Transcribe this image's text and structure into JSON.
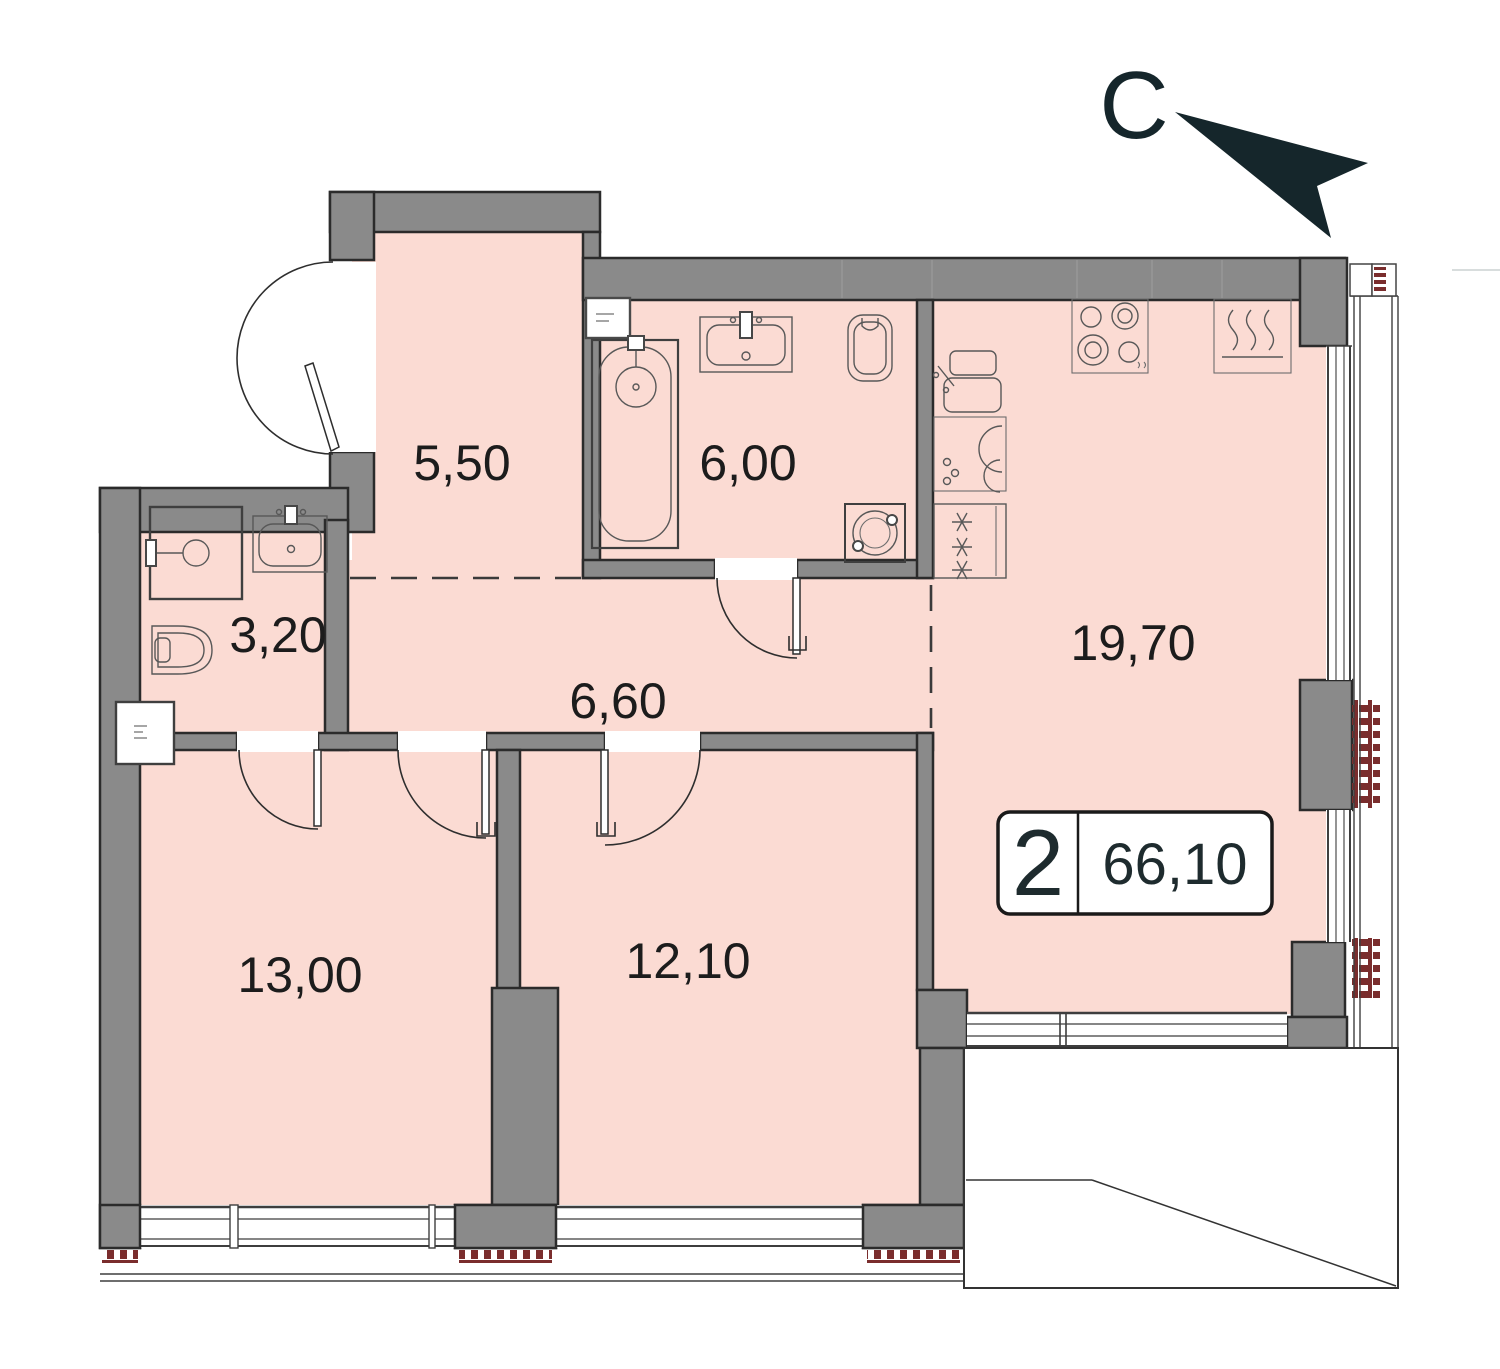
{
  "plan": {
    "type": "apartment-floor-plan",
    "north_label": "С",
    "area_badge": {
      "rooms_count": "2",
      "total_area": "66,10"
    },
    "rooms": [
      {
        "id": "entry-hall",
        "area_label": "5,50"
      },
      {
        "id": "bathroom",
        "area_label": "6,00"
      },
      {
        "id": "wc-shower",
        "area_label": "3,20"
      },
      {
        "id": "corridor",
        "area_label": "6,60"
      },
      {
        "id": "kitchen-living",
        "area_label": "19,70"
      },
      {
        "id": "bedroom-1",
        "area_label": "13,00"
      },
      {
        "id": "bedroom-2",
        "area_label": "12,10"
      }
    ],
    "fixtures": [
      "bathtub",
      "washbasin",
      "toilet",
      "shower",
      "washing-machine",
      "kitchen-sink",
      "stove",
      "oven-heater",
      "fridge"
    ],
    "colors": {
      "room_fill": "#fbdbd3",
      "wall": "#8a8a8a",
      "wall_outline": "#2b2b2b",
      "hatch_red": "#7a2d2d",
      "north_arrow": "#15262b"
    }
  }
}
